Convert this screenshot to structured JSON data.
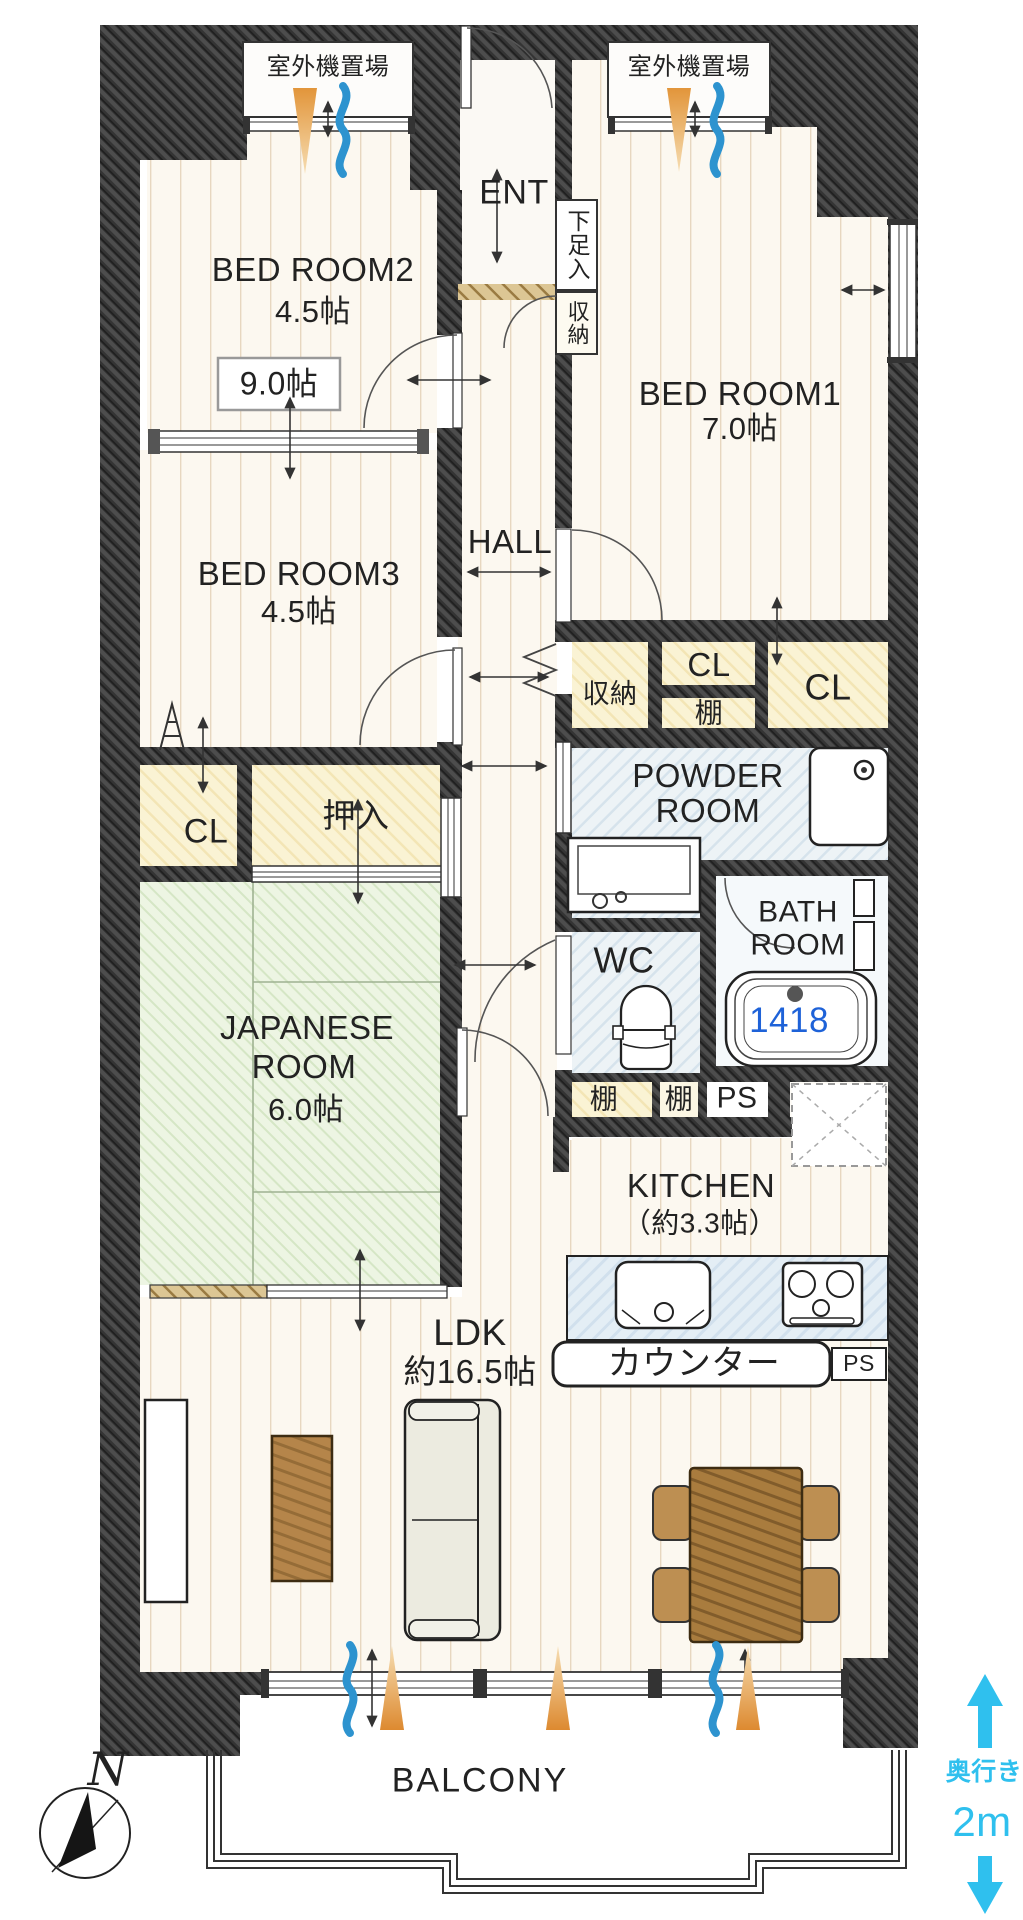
{
  "colors": {
    "wall_dark": "#3a3a3a",
    "tatami_green": "#edf5e3",
    "closet_yellow": "#faf3d4",
    "wet_blue": "#edf3f6",
    "tub_number_blue": "#1e62d8",
    "depth_cyan": "#2fc0ee",
    "cone_orange": "#e2953a",
    "wave_blue": "#2d93cf"
  },
  "labels": {
    "outdoor_unit_left": "室外機置場",
    "outdoor_unit_right": "室外機置場",
    "entrance": "ENT",
    "shoe_cabinet": "下足入",
    "entrance_storage": "収納",
    "bedroom2_name": "BED ROOM2",
    "bedroom2_size": "4.5帖",
    "combined_size": "9.0帖",
    "bedroom1_name": "BED ROOM1",
    "bedroom1_size": "7.0帖",
    "bedroom3_name": "BED ROOM3",
    "bedroom3_size": "4.5帖",
    "hall": "HALL",
    "hall_storage": "収納",
    "cl_upper": "CL",
    "shelf_upper": "棚",
    "cl_upper_right": "CL",
    "powder_line1": "POWDER",
    "powder_line2": "ROOM",
    "bath_line1": "BATH",
    "bath_line2": "ROOM",
    "bathtub_size": "1418",
    "wc": "WC",
    "wc_shelf_left": "棚",
    "wc_shelf_right": "棚",
    "ps_upper": "PS",
    "cl_lower": "CL",
    "oshiire": "押入",
    "japanese_line1": "JAPANESE",
    "japanese_line2": "ROOM",
    "japanese_size": "6.0帖",
    "kitchen_name": "KITCHEN",
    "kitchen_size": "（約3.3帖）",
    "counter": "カウンター",
    "ps_lower": "PS",
    "ldk_name": "LDK",
    "ldk_size": "約16.5帖",
    "balcony": "BALCONY",
    "compass": "N",
    "depth_label": "奥行き",
    "depth_value": "2m"
  }
}
